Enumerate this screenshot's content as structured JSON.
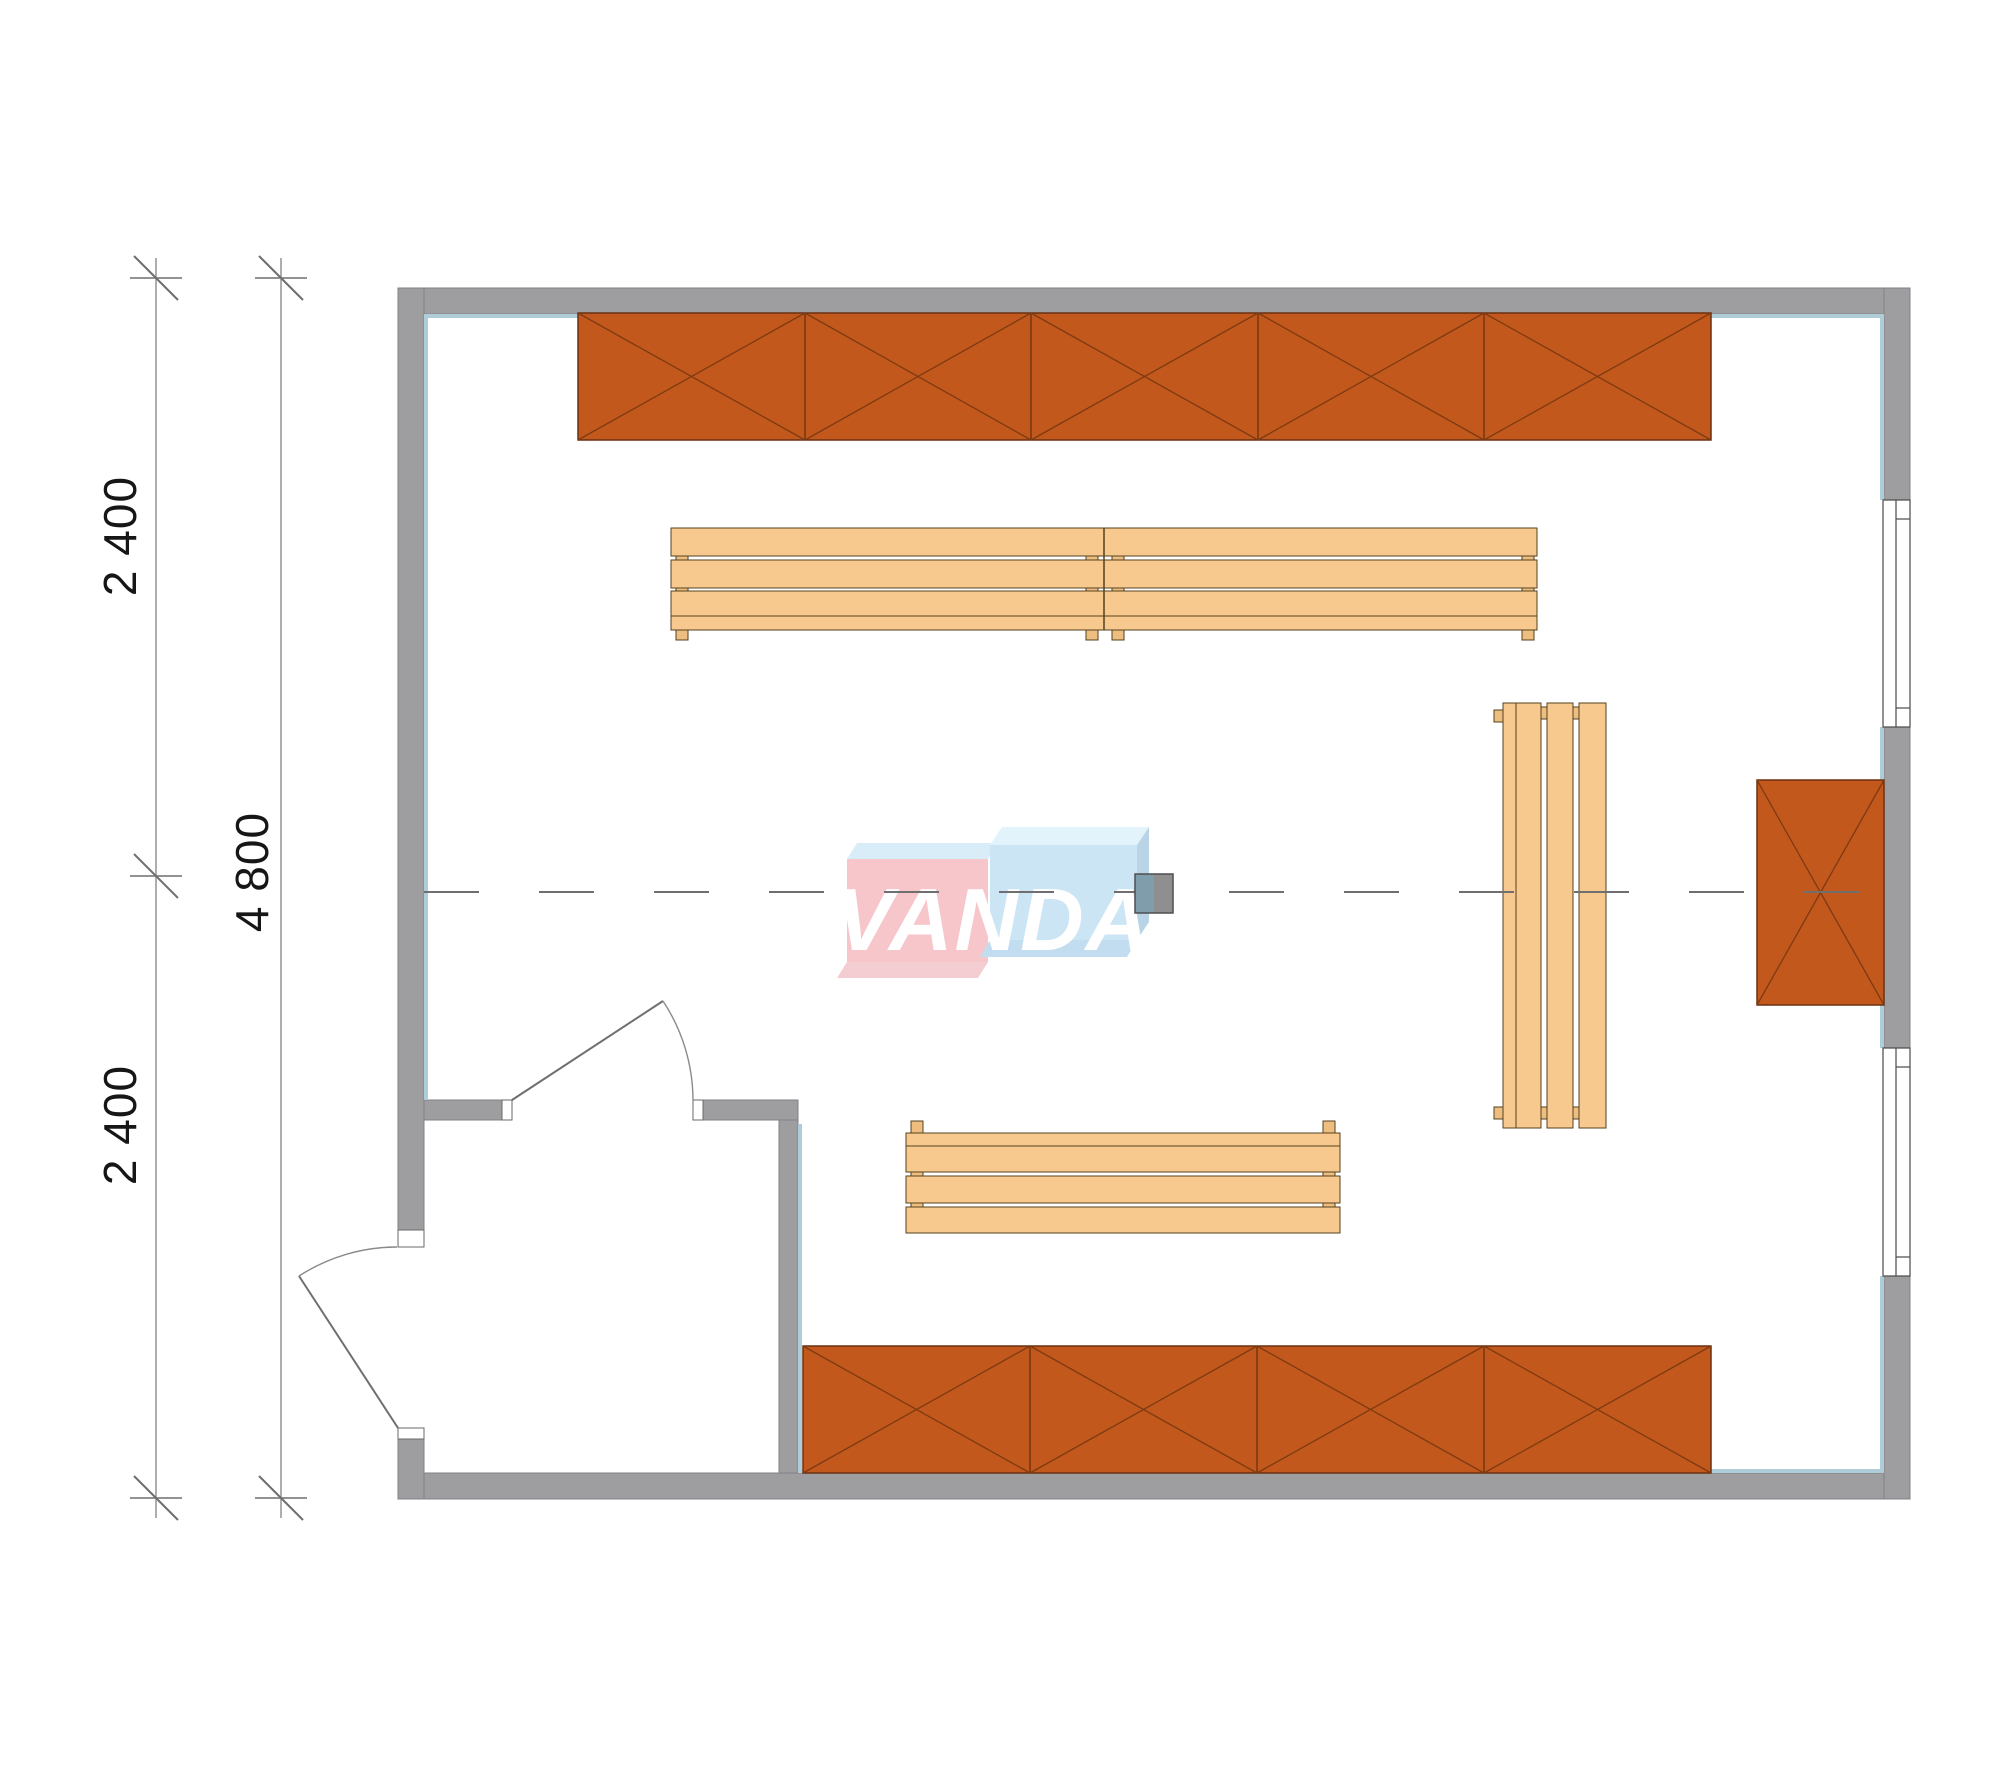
{
  "drawing": {
    "type": "sauna-floor-plan",
    "units": "mm",
    "dimensions": {
      "upper_segment_label": "2 400",
      "lower_segment_label": "2 400",
      "total_label": "4 800"
    },
    "watermark": {
      "text": "VANDA"
    },
    "colors": {
      "wall_fill": "#9e9ea0",
      "wall_edge": "#828287",
      "wall_inner_lining": "#afcdd9",
      "cabinet_fill": "#c2581c",
      "cabinet_line": "#7e3a12",
      "bench_fill": "#f8c98e",
      "bench_line": "#55411f",
      "bench_foot_fill": "#edbe80",
      "centerline": "#6f6f6f",
      "dimension_line": "#8c8c8c",
      "logo_pink_face": "#f6c6cb",
      "logo_blue_face": "#cce5f5",
      "stove_left": "#7f9dab",
      "stove_right": "#8f8f90"
    },
    "inventory": {
      "top_wall_cabinet_units": 5,
      "bottom_wall_cabinet_units": 4,
      "right_wall_cabinet_units": 1,
      "benches": 3,
      "windows": 2,
      "doors": 2
    }
  }
}
